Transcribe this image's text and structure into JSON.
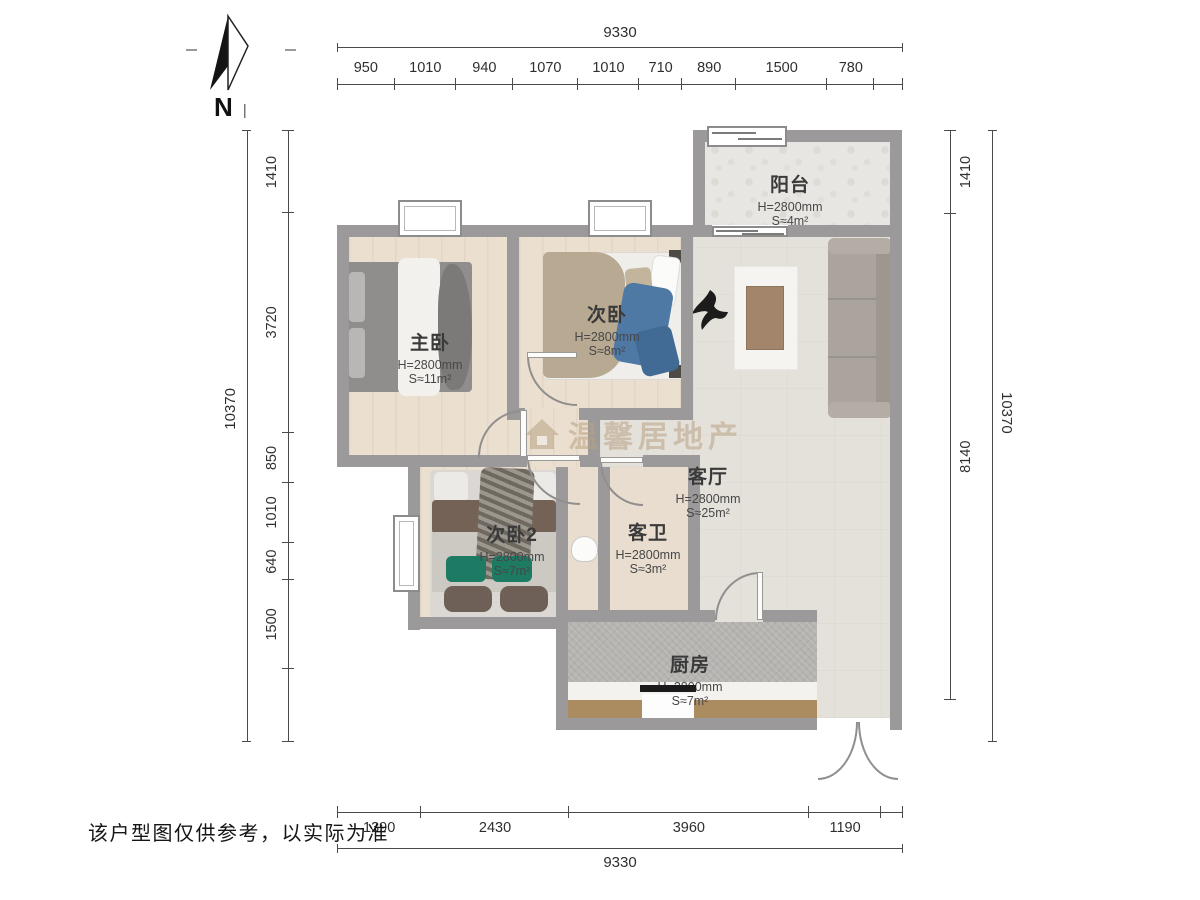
{
  "north": {
    "label": "N"
  },
  "disclaimer": "该户型图仅供参考，以实际为准",
  "watermark": {
    "brand": "温馨居地产"
  },
  "rooms": {
    "balcony": {
      "name": "阳台",
      "h": "H=2800mm",
      "s": "S≈4m²"
    },
    "master": {
      "name": "主卧",
      "h": "H=2800mm",
      "s": "S≈11m²"
    },
    "bedroom2": {
      "name": "次卧",
      "h": "H=2800mm",
      "s": "S≈8m²"
    },
    "living": {
      "name": "客厅",
      "h": "H=2800mm",
      "s": "S≈25m²"
    },
    "bedroom3": {
      "name": "次卧2",
      "h": "H=2800mm",
      "s": "S≈7m²"
    },
    "bath": {
      "name": "客卫",
      "h": "H=2800mm",
      "s": "S≈3m²"
    },
    "kitchen": {
      "name": "厨房",
      "h": "H=2800mm",
      "s": "S≈7m²"
    }
  },
  "dimensions": {
    "top": {
      "total": "9330",
      "segments": [
        "950",
        "1010",
        "940",
        "1070",
        "1010",
        "710",
        "890",
        "1500",
        "780"
      ]
    },
    "bottom": {
      "total": "9330",
      "segments": [
        "1390",
        "2430",
        "3960",
        "1190"
      ]
    },
    "left": {
      "total": "10370",
      "segments": [
        "1410",
        "3720",
        "850",
        "1010",
        "640",
        "1500"
      ]
    },
    "right": {
      "total": "10370",
      "segments": [
        "1410",
        "8140"
      ]
    }
  },
  "colors": {
    "wall": "#9b999a",
    "wood_floor": "#ebdfd0",
    "living_floor": "#e4e1db",
    "kitchen_floor": "#b5b3b0",
    "counter": "#aa8c60",
    "green_cushion": "#1d7a63",
    "blue_clothes": "#4e79a4",
    "watermark": "#b8a284"
  }
}
